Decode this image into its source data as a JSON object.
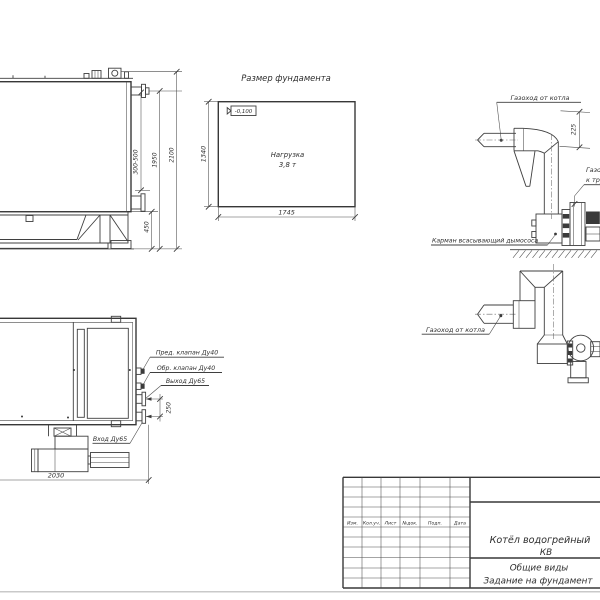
{
  "colors": {
    "line": "#3f3f3f",
    "text": "#2e2e2e",
    "page": "#ffffff",
    "sheet_edge": "#c9c9c9"
  },
  "views": {
    "side_view": {
      "dims": {
        "adjustable": "300-500",
        "height_flange": "1950",
        "height_total": "2100",
        "base_height": "450"
      }
    },
    "foundation": {
      "title": "Размер фундамента",
      "elevation_mark": "-0,100",
      "load_line1": "Нагрузка",
      "load_line2": "3,8 т",
      "width": "1745",
      "depth": "1340"
    },
    "flue_elevation": {
      "label_from_boiler": "Газоход от котла",
      "offset": "225",
      "label_to_stack_line1": "Газоход",
      "label_to_stack_line2": "к трубе",
      "label_pocket": "Карман всасывающий дымососа"
    },
    "flue_plan": {
      "label_from_boiler": "Газоход от котла"
    },
    "boiler_plan": {
      "safety_valve": "Пред. клапан Ду40",
      "check_valve": "Обр. клапан Ду40",
      "outlet": "Выход Ду65",
      "inlet": "Вход Ду65",
      "flange_spacing": "250",
      "length": "2030"
    }
  },
  "title_block": {
    "columns": [
      "Изм.",
      "Кол.уч.",
      "Лист",
      "№док.",
      "Подп.",
      "Дата"
    ],
    "product_line1": "Котёл водогрейный",
    "product_line2": "КВ",
    "doc_line1": "Общие виды",
    "doc_line2": "Задание на фундамент"
  }
}
